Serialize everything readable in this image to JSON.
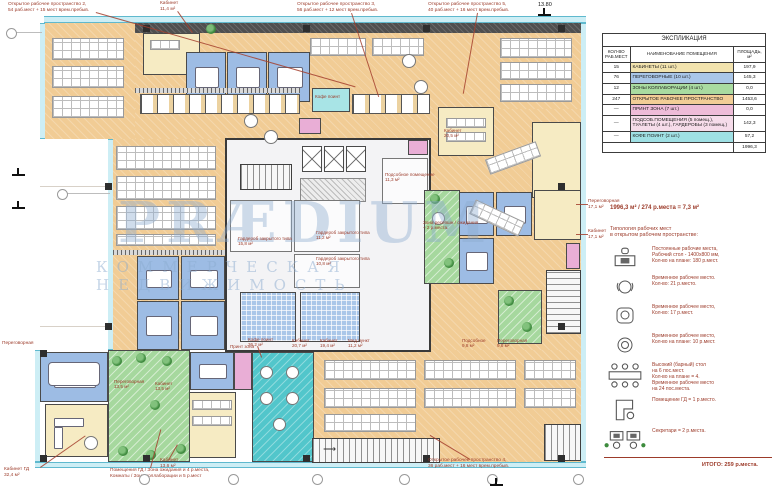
{
  "watermark": {
    "line1": "PRÆDIUM",
    "line2": "КОММЕРЧЕСКАЯ НЕДВИЖИМОСТЬ"
  },
  "legend": {
    "title": "ЭКСПЛИКАЦИЯ",
    "headers": [
      "КОЛ-ВО РАБ.МЕСТ",
      "НАИМЕНОВАНИЕ ПОМЕЩЕНИЯ",
      "ПЛОЩАДЬ, м²"
    ],
    "rows": [
      {
        "count": "15",
        "name": "КАБИНЕТЫ (11 шт.)",
        "area": "197,9",
        "color": "#f2e3ae"
      },
      {
        "count": "76",
        "name": "ПЕРЕГОВОРНЫЕ (10 шт.)",
        "area": "145,3",
        "color": "#a9c6e8"
      },
      {
        "count": "12",
        "name": "ЗОНЫ КОЛЛАБОРАЦИИ (4 шт.)",
        "area": "0,0",
        "color": "#a9dba0"
      },
      {
        "count": "247",
        "name": "ОТКРЫТОЕ РАБОЧЕЕ ПРОСТРАНСТВО",
        "area": "1453,6",
        "color": "#f2cd96"
      },
      {
        "count": "—",
        "name": "ПРИНТ ЗОНА (7 шт.)",
        "area": "0,0",
        "color": "#eebcd8"
      },
      {
        "count": "—",
        "name": "ПОДСОБ.ПОМЕЩЕНИЯ (5 помещ.), ТУАЛЕТЫ (4 шт.), ГАРДЕРОБЫ (3 помещ.)",
        "area": "142,3",
        "color": "#f6dcea"
      },
      {
        "count": "—",
        "name": "КОФЕ ПОИНТ (2 шт.)",
        "area": "57,2",
        "color": "#9fe0e4"
      }
    ],
    "total_area": "1996,3"
  },
  "summary": "1996,3 м² / 274 р.места = 7,3 м²",
  "typology": {
    "intro_lines": [
      "Типология рабочих мест",
      "в открытом рабочем пространстве:"
    ],
    "items": [
      {
        "icon": "desk-icon",
        "lines": [
          "Постоянные рабочие места,",
          "Рабочий стол - 1400х800 мм,",
          "Кол-во на плане: 180 р.мест."
        ]
      },
      {
        "icon": "office-chair-icon",
        "lines": [
          "Временное рабочее место.",
          "Кол-во: 21 р.место."
        ]
      },
      {
        "icon": "lounge-chair-icon",
        "lines": [
          "Временное рабочее место,",
          "Кол-во: 17 р.мест."
        ]
      },
      {
        "icon": "pouf-icon",
        "lines": [
          "Временное рабочее место,",
          "Кол-во на плане: 10 р.мест."
        ]
      },
      {
        "icon": "bar-table-icon",
        "lines": [
          "Высокий (барный) стол",
          "на 6 пос.мест.",
          "Кол-во на плане = 4.",
          "Временное рабочее место",
          "на 24 пос.места."
        ]
      },
      {
        "icon": "director-desk-icon",
        "lines": [
          "Помещение ГД = 1 р.место."
        ]
      },
      {
        "icon": "secretary-desks-icon",
        "lines": [
          "Секретари = 2 р.места."
        ]
      }
    ],
    "total": "ИТОГО: 259 р.места."
  },
  "plan": {
    "annotations": [
      {
        "lines": [
          "Открытое рабочее пространство 2,",
          "54 раб.мест + 15 мест врем.пребыв."
        ],
        "x": 8,
        "y": 2
      },
      {
        "lines": [
          "Кабинет",
          "11,4 м²"
        ],
        "x": 160,
        "y": 1
      },
      {
        "lines": [
          "Открытое рабочее пространство 3,",
          "56 раб.мест + 12 мест врем.пребыв."
        ],
        "x": 297,
        "y": 2
      },
      {
        "lines": [
          "Открытое рабочее пространство 5,",
          "40 раб.мест + 16 мест врем.пребыв."
        ],
        "x": 428,
        "y": 2
      },
      {
        "lines": [
          "Кабинет ГД",
          "32,4 м²"
        ],
        "x": 4,
        "y": 467
      },
      {
        "lines": [
          "Помещения ГД / Зона ожидания и 4 р.места,",
          "Комнаты / Зона коллаборации и 5 р.мест"
        ],
        "x": 110,
        "y": 468
      },
      {
        "lines": [
          "Кабинет",
          "13,6 м²"
        ],
        "x": 160,
        "y": 458
      },
      {
        "lines": [
          "Открытое рабочее пространство 4,",
          "36 раб.мест + 16 мест врем.пребыв."
        ],
        "x": 428,
        "y": 458
      },
      {
        "lines": [
          "Переговорная",
          "17,1 м²"
        ],
        "x": 588,
        "y": 199
      },
      {
        "lines": [
          "Кабинет",
          "17,1 м²"
        ],
        "x": 588,
        "y": 229
      },
      {
        "lines": [
          "Переговорная"
        ],
        "x": 2,
        "y": 341
      }
    ],
    "room_labels": [
      {
        "lines": [
          "Кофе поинт",
          "36,2 м²"
        ],
        "x": 248,
        "y": 337
      },
      {
        "lines": [
          "Кабинет",
          "20,7 м²"
        ],
        "x": 292,
        "y": 338
      },
      {
        "lines": [
          "Кабинет",
          "19,4 м²"
        ],
        "x": 320,
        "y": 338
      },
      {
        "lines": [
          "Мед.пункт",
          "11,2 м²"
        ],
        "x": 348,
        "y": 338
      },
      {
        "lines": [
          "Подсобное",
          "9,8 м²"
        ],
        "x": 462,
        "y": 338
      },
      {
        "lines": [
          "Переговорная",
          "9,8 м²"
        ],
        "x": 497,
        "y": 338
      },
      {
        "lines": [
          "Гардероб закрытого типа",
          "15,8 м²"
        ],
        "x": 238,
        "y": 236
      },
      {
        "lines": [
          "Гардероб закрытого типа",
          "11,2 м²"
        ],
        "x": 316,
        "y": 230
      },
      {
        "lines": [
          "Гардероб закрытого типа",
          "10,8 м²"
        ],
        "x": 316,
        "y": 256
      },
      {
        "lines": [
          "Подсобное помещение",
          "11,3 м²"
        ],
        "x": 385,
        "y": 172
      },
      {
        "lines": [
          "Зона ресепшн / ожидания",
          "– 2 р.места."
        ],
        "x": 423,
        "y": 220
      },
      {
        "lines": [
          "Переговорная",
          "13,5 м²"
        ],
        "x": 114,
        "y": 379
      },
      {
        "lines": [
          "Кабинет",
          "13,5 м²"
        ],
        "x": 155,
        "y": 381
      },
      {
        "lines": [
          "Кабинет",
          "20,5 м²"
        ],
        "x": 444,
        "y": 128
      },
      {
        "lines": [
          "Кофе поинт"
        ],
        "x": 315,
        "y": 94
      },
      {
        "lines": [
          "Принт зона"
        ],
        "x": 230,
        "y": 344
      }
    ],
    "elevation_marks": [
      {
        "value": "13.80",
        "x": 538,
        "y": 2
      },
      {
        "value": "",
        "x": 12,
        "y": 168
      },
      {
        "value": "",
        "x": 12,
        "y": 201
      },
      {
        "value": "",
        "x": 490,
        "y": 478
      }
    ],
    "axis_bubbles": [
      {
        "x": 6,
        "y": 28
      },
      {
        "x": 57,
        "y": 189
      },
      {
        "x": 139,
        "y": 474
      },
      {
        "x": 228,
        "y": 474
      },
      {
        "x": 312,
        "y": 474
      },
      {
        "x": 399,
        "y": 474
      },
      {
        "x": 487,
        "y": 474
      },
      {
        "x": 573,
        "y": 474
      }
    ]
  }
}
